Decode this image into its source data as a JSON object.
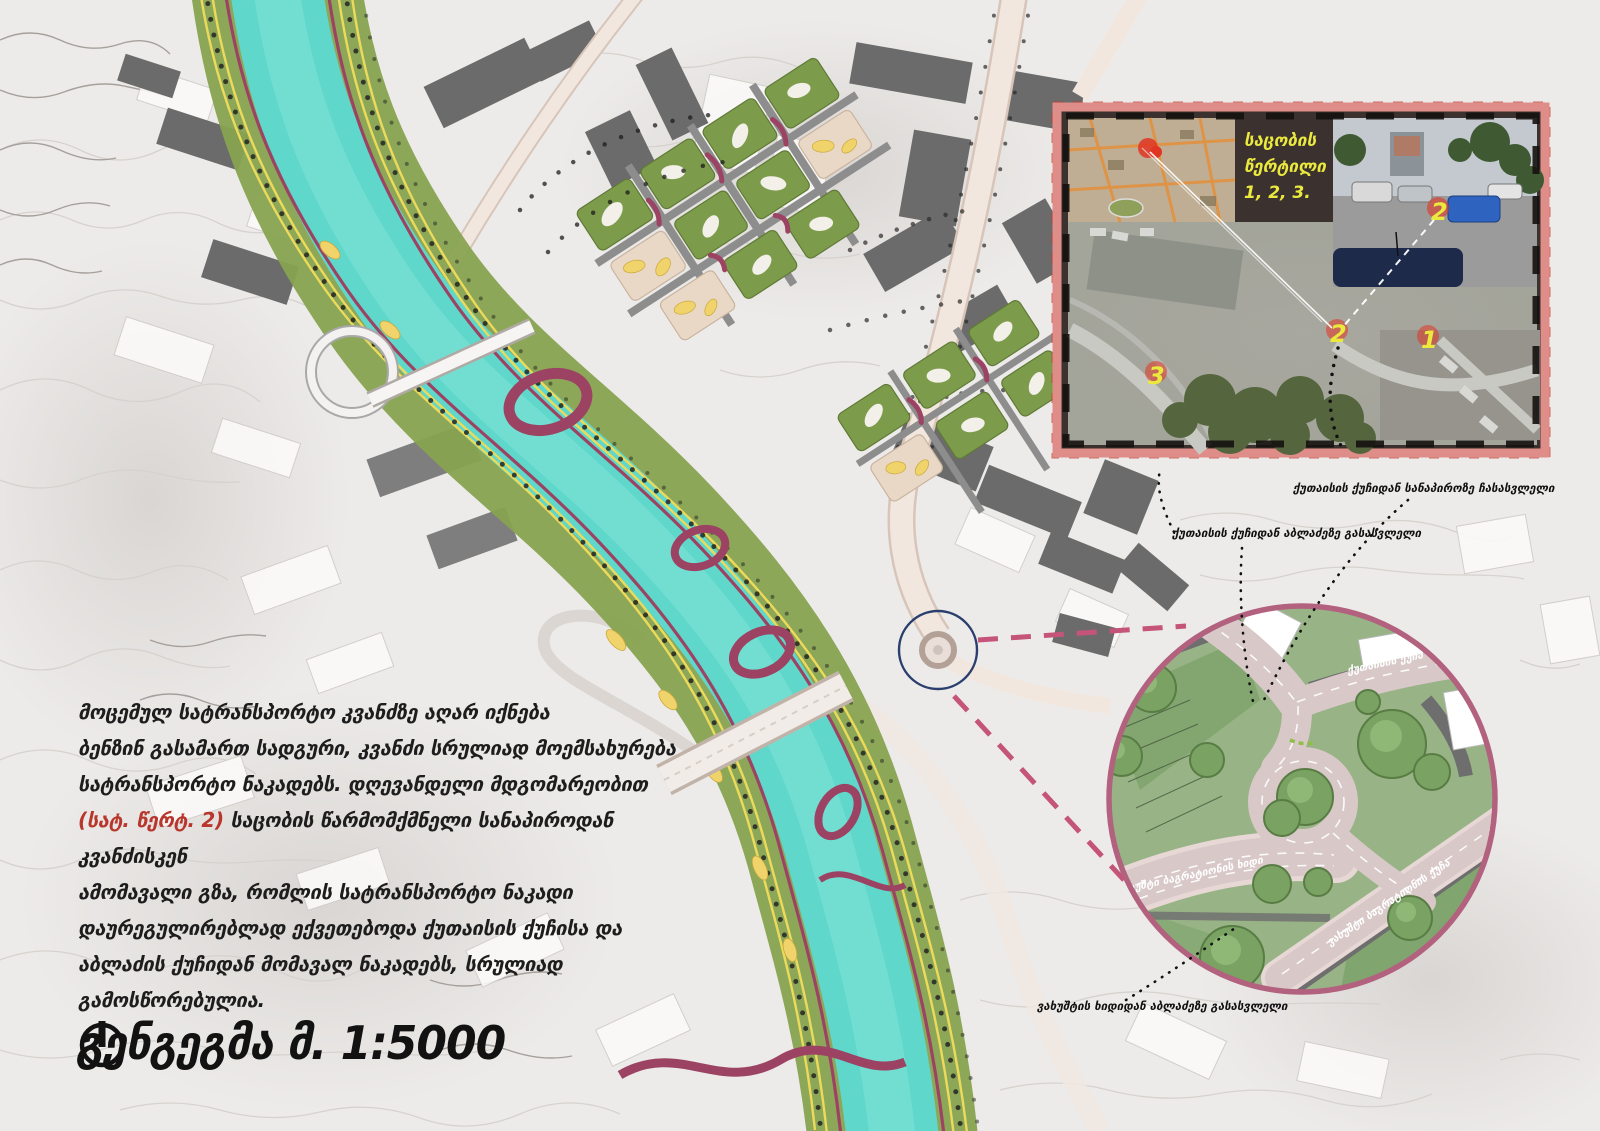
{
  "title": {
    "text": "გენგეგმა მ. 1:5000",
    "north_icon": "north-arrow"
  },
  "paragraph": {
    "lines_before": [
      "მოცემულ სატრანსპორტო კვანძზე აღარ იქნება",
      "ბენზინ გასამართ სადგური, კვანძი სრულიად მოემსახურება",
      "სატრანსპორტო ნაკადებს. დღევანდელი მდგომარეობით"
    ],
    "highlight": "(სატ. წერტ. 2)",
    "highlight_rest": " საცობის წარმომქმნელი სანაპიროდან კვანძისკენ",
    "lines_after": [
      "ამომავალი გზა, რომლის სატრანსპორტო ნაკადი",
      "დაურეგულირებლად ექვეთებოდა ქუთაისის ქუჩისა და",
      "აბლაძის ქუჩიდან მომავალ ნაკადებს, სრულიად",
      "გამოსწორებულია."
    ]
  },
  "callouts": {
    "c1": "ქუთაისის ქუჩიდან სანაპიროზე ჩასასვლელი",
    "c2": "ქუთაისის ქუჩიდან აბლაძეზე გასასვლელი",
    "c3": "ვახუშტის ხიდიდან აბლაძეზე გასასვლელი"
  },
  "inset": {
    "caption_lines": [
      "საცობის",
      "წერტილი",
      "1, 2, 3."
    ],
    "markers": {
      "m1": "1",
      "m2": "2",
      "m3": "3",
      "photo": "2"
    }
  },
  "detail": {
    "roads": {
      "kutaisi": "ქუთაისის ქუჩა",
      "bridge": "ვახუშტი ბაგრატიონის ხიდი",
      "street": "ვახუშტი ბაგრატიონის ქუჩა"
    }
  },
  "colors": {
    "river": "#5fd7cb",
    "embankment": "#88a351",
    "ribbon": "#9c4363",
    "circle_border": "#b2627e",
    "inset_border": "#df8d88",
    "marker_yellow": "#ebe93e",
    "highlight_red": "#b8362c"
  }
}
